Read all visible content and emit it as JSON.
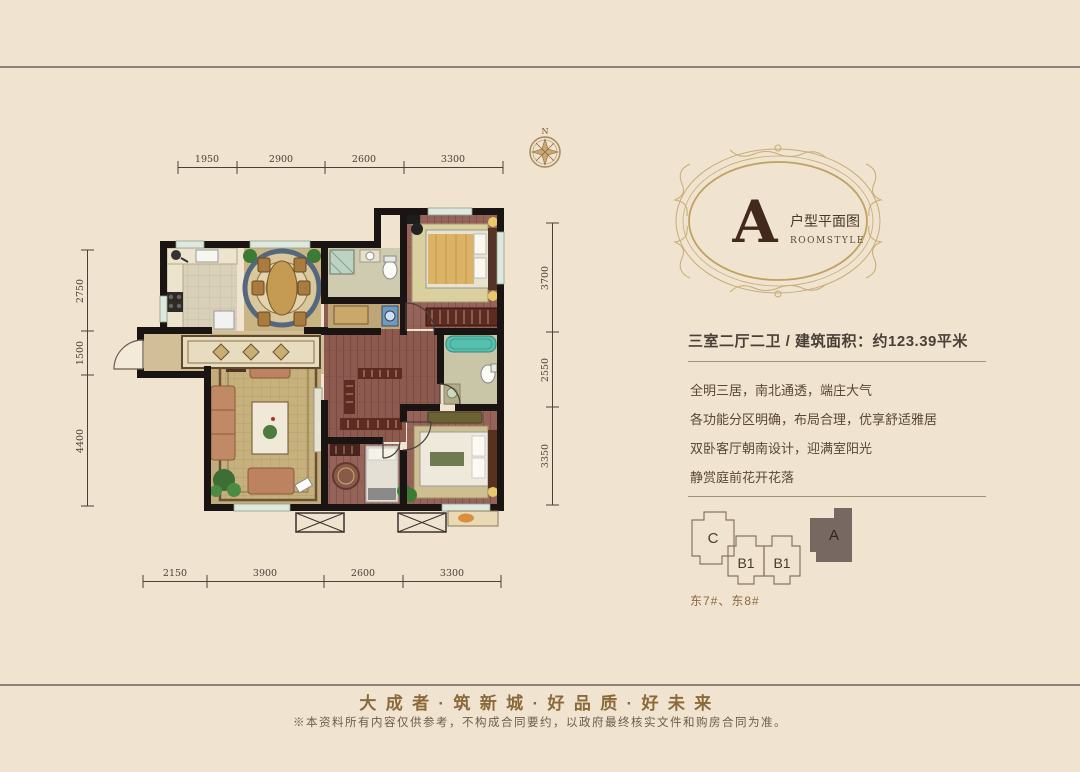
{
  "page": {
    "bg_color": "#f0e3d0",
    "wall_color": "#1a1512",
    "accent_gold": "#c6ad74"
  },
  "plan": {
    "compass_label": "N",
    "dims_top": [
      "1950",
      "2900",
      "2600",
      "3300"
    ],
    "dims_left": [
      "2750",
      "1500",
      "4400"
    ],
    "dims_right": [
      "3700",
      "2550",
      "3350"
    ],
    "dims_bottom": [
      "2150",
      "3900",
      "2600",
      "3300"
    ]
  },
  "badge": {
    "letter": "A",
    "title": "户型平面图",
    "subtitle": "ROOMSTYLE"
  },
  "details": {
    "headline": "三室二厅二卫 / 建筑面积：约123.39平米",
    "features": [
      "全明三居，南北通透，端庄大气",
      "各功能分区明确，布局合理，优享舒适雅居",
      "双卧客厅朝南设计，迎满室阳光",
      "静赏庭前花开花落"
    ]
  },
  "keyplan": {
    "blocks": [
      "C",
      "B1",
      "B1",
      "A"
    ],
    "active_block": "A",
    "active_color": "#786862",
    "caption": "东7#、东8#"
  },
  "footer": {
    "slogan": "大成者·筑新城·好品质·好未来",
    "disclaimer": "※本资料所有内容仅供参考，不构成合同要约，以政府最终核实文件和购房合同为准。"
  }
}
